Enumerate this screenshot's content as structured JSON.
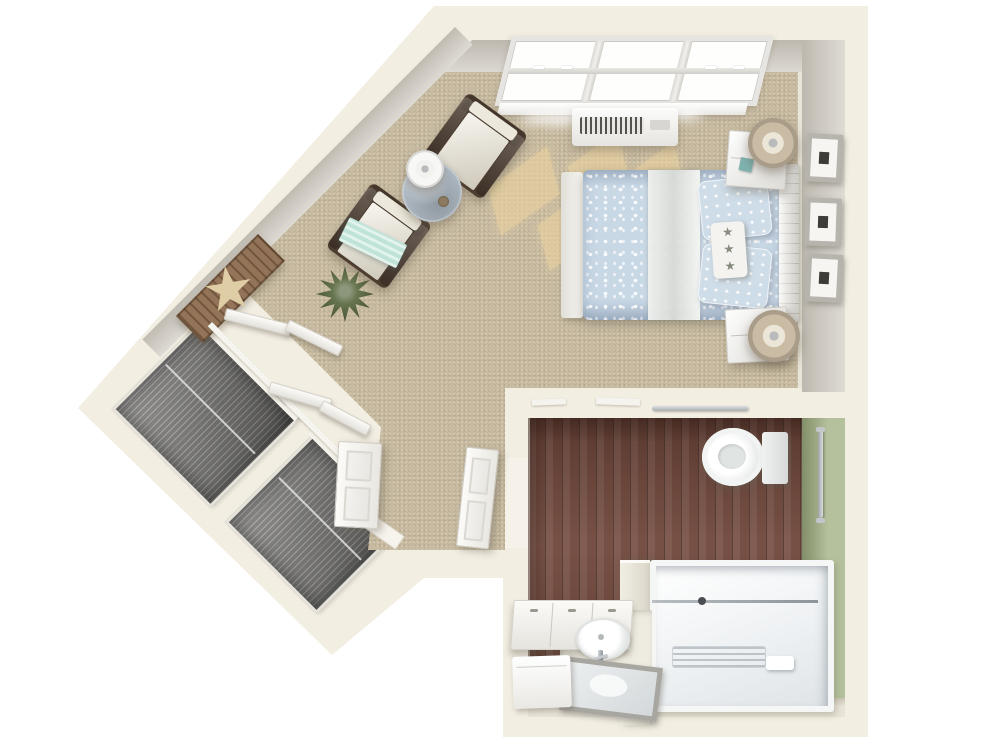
{
  "scene": {
    "title": "3D rendered studio apartment floor plan, top-down view",
    "rooms": [
      "bedroom-living-area",
      "bathroom",
      "closets",
      "entry"
    ]
  },
  "palette": {
    "outside": "#ffffff",
    "wall": "#f2eee2",
    "wall_face": "#d8d4cc",
    "carpet": "#c6b99e",
    "sun_patch": "#ecd3a0",
    "wood_floor": "#6f463a",
    "green_wall": "#a7b489",
    "tile": "#e9e4d7",
    "white_fixture": "#f7f7f5",
    "closet_interior": "#7d7c7a",
    "bedding_blue": "#c9d8e5",
    "pillow_blue": "#cfdde9",
    "pillow_white": "#f4f3ef",
    "star_motif": "#868b7e",
    "throw_teal": "#bfe3d6",
    "teal_decor": "#7fb3b0",
    "chair_wood": "#4e3e32",
    "cushion_cream": "#ece8db",
    "lamp_shade_tan": "#c9bba4",
    "table_top_bluegrey": "#b0bbc5",
    "art_board_brown": "#8a684a",
    "starfish_tan": "#dfcda6",
    "plant_green": "#66754f",
    "frame_grey": "#b7b4ae"
  },
  "bedroom": {
    "floor": "carpet",
    "furniture": [
      "queen-bed",
      "headboard",
      "footboard",
      "nightstand-upper",
      "nightstand-lower",
      "drum-lamp-upper",
      "drum-lamp-lower",
      "armchair-upper",
      "armchair-lower",
      "round-side-table",
      "table-lamp",
      "potted-plant",
      "starfish-wall-art"
    ],
    "wall_items": [
      "picture-frame",
      "picture-frame",
      "picture-frame"
    ],
    "fixtures": [
      "triple-window",
      "ptac-heat-ac-unit"
    ],
    "textiles": [
      "blue-floral-duvet",
      "blue-floral-pillows",
      "starfish-accent-pillow",
      "teal-striped-throw"
    ]
  },
  "bathroom": {
    "floor": "dark-wood",
    "accent_wall": "sage-green",
    "fixtures": [
      "toilet",
      "walk-in-shower",
      "shower-glass-panel",
      "vanity-sink",
      "faucet",
      "tilted-mirror",
      "wall-cabinets",
      "hamper",
      "vertical-grab-bar",
      "horizontal-grab-bar"
    ]
  },
  "closets": {
    "count": 2,
    "features": [
      "wire-shelving",
      "hanging-rod",
      "bifold-doors"
    ]
  },
  "doors": [
    "entry-door-open",
    "bathroom-door-open"
  ]
}
